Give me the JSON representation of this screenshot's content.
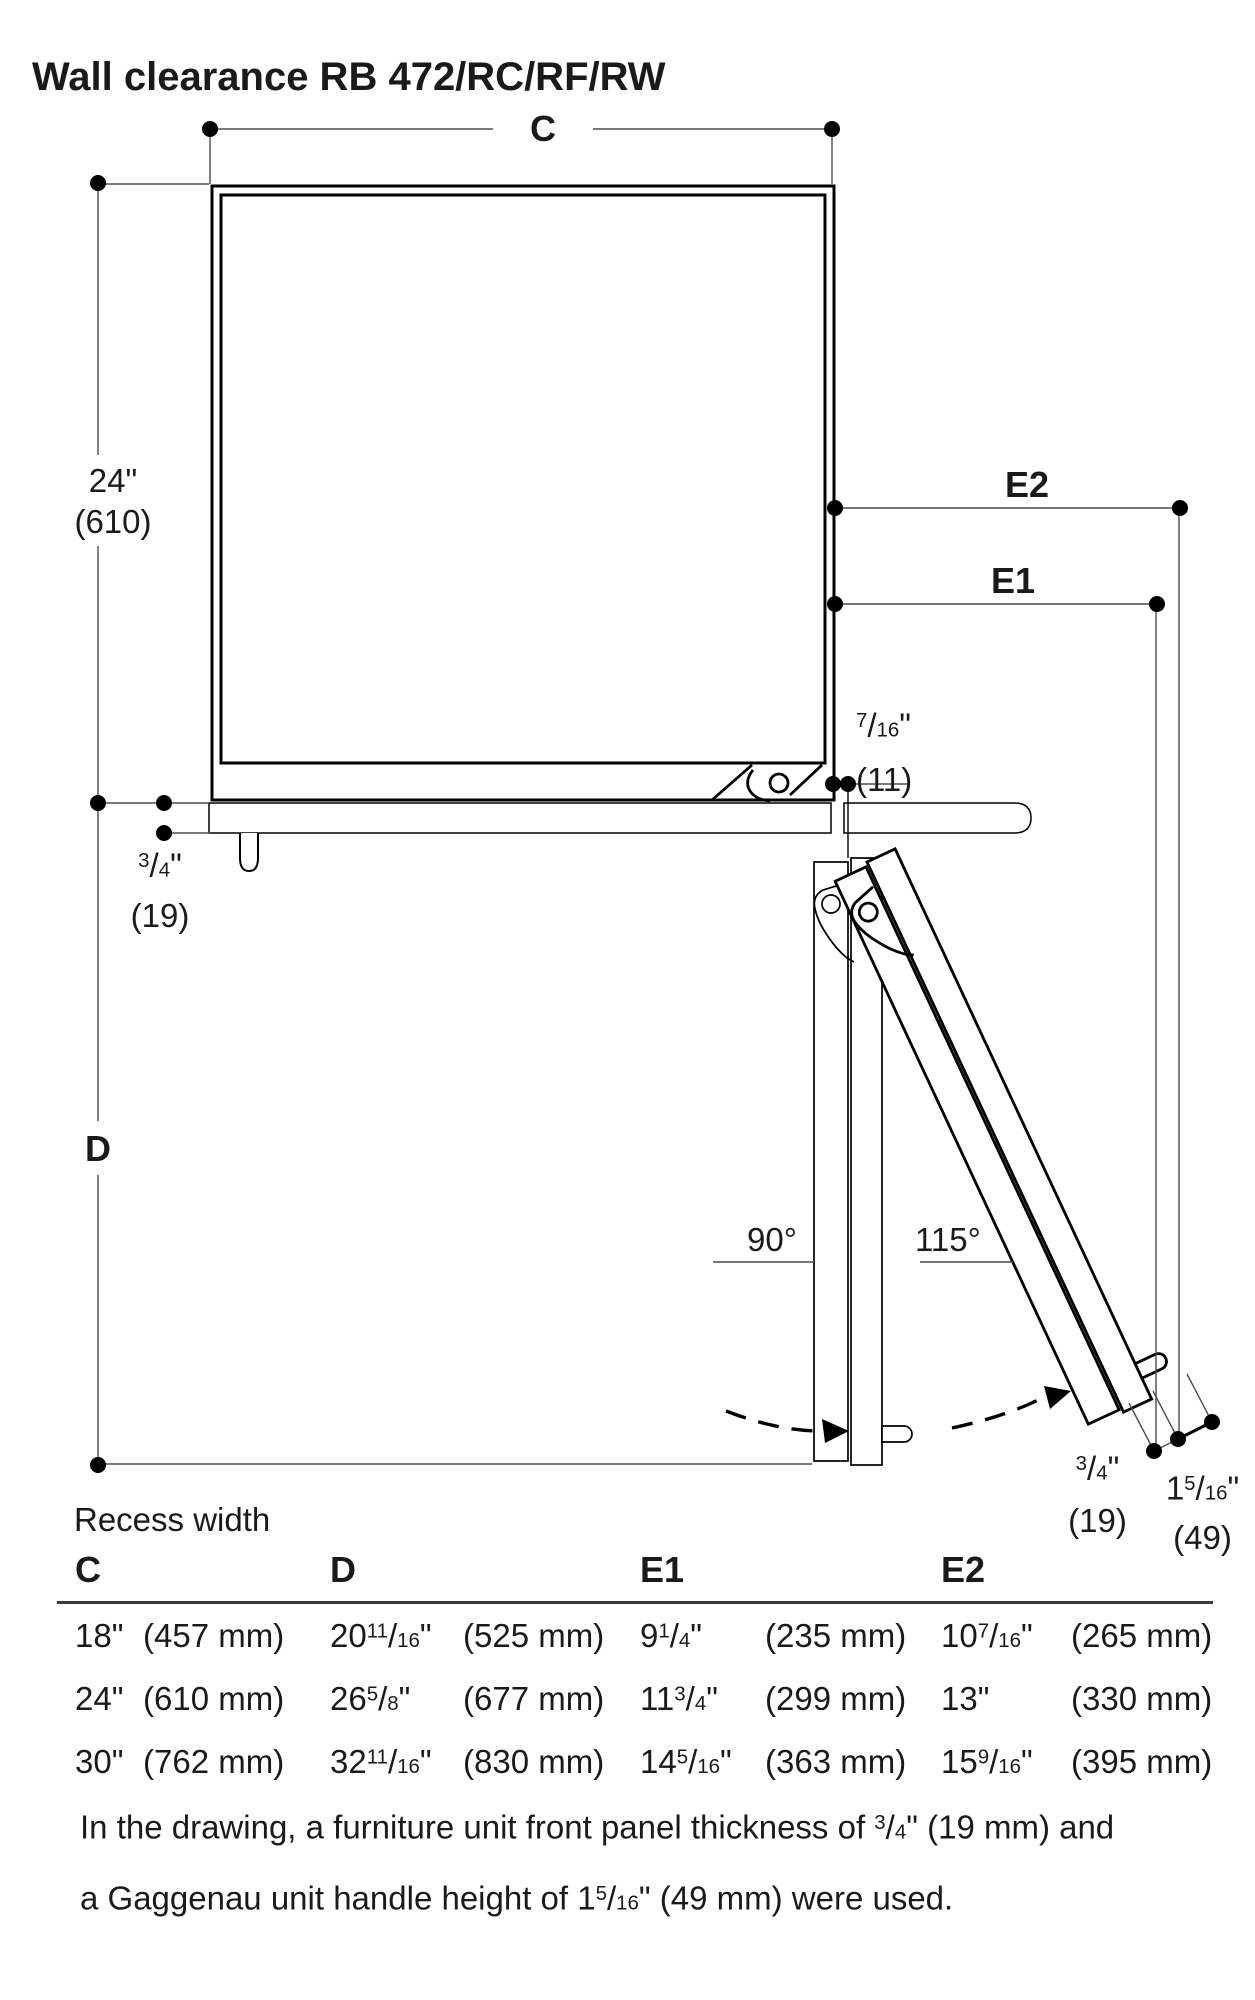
{
  "title": "Wall clearance RB 472/RC/RF/RW",
  "drawing": {
    "dim_c": "C",
    "dim_d": "D",
    "dim_e1": "E1",
    "dim_e2": "E2",
    "depth": {
      "inches": "24\"",
      "mm": "(610)"
    },
    "panel_left": {
      "num": "3",
      "slash": "/",
      "den": "4",
      "unit": "\"",
      "mm": "(19)"
    },
    "gap": {
      "num": "7",
      "slash": "/",
      "den": "16",
      "unit": "\"",
      "mm": "(11)"
    },
    "angle_door_90": "90°",
    "angle_door_115": "115°",
    "panel_tip": {
      "num": "3",
      "slash": "/",
      "den": "4",
      "unit": "\"",
      "mm": "(19)"
    },
    "handle_tip": {
      "whole": "1",
      "num": "5",
      "slash": "/",
      "den": "16",
      "unit": "\"",
      "mm": "(49)"
    }
  },
  "table": {
    "caption": "Recess width",
    "headers": {
      "c": "C",
      "d": "D",
      "e1": "E1",
      "e2": "E2"
    },
    "rows": [
      {
        "c_in": "18\"",
        "c_mm": "(457 mm)",
        "d_whole": "20",
        "d_num": "11",
        "d_slash": "/",
        "d_den": "16",
        "d_unit": "\"",
        "d_mm": "(525 mm)",
        "e1_whole": "9",
        "e1_num": "1",
        "e1_slash": "/",
        "e1_den": "4",
        "e1_unit": "\"",
        "e1_mm": "(235 mm)",
        "e2_whole": "10",
        "e2_num": "7",
        "e2_slash": "/",
        "e2_den": "16",
        "e2_unit": "\"",
        "e2_mm": "(265 mm)"
      },
      {
        "c_in": "24\"",
        "c_mm": "(610 mm)",
        "d_whole": "26",
        "d_num": "5",
        "d_slash": "/",
        "d_den": "8",
        "d_unit": "\"",
        "d_mm": "(677 mm)",
        "e1_whole": "11",
        "e1_num": "3",
        "e1_slash": "/",
        "e1_den": "4",
        "e1_unit": "\"",
        "e1_mm": "(299 mm)",
        "e2_whole": "13",
        "e2_num": "",
        "e2_slash": "",
        "e2_den": "",
        "e2_unit": "\"",
        "e2_mm": "(330 mm)"
      },
      {
        "c_in": "30\"",
        "c_mm": "(762 mm)",
        "d_whole": "32",
        "d_num": "11",
        "d_slash": "/",
        "d_den": "16",
        "d_unit": "\"",
        "d_mm": "(830 mm)",
        "e1_whole": "14",
        "e1_num": "5",
        "e1_slash": "/",
        "e1_den": "16",
        "e1_unit": "\"",
        "e1_mm": "(363 mm)",
        "e2_whole": "15",
        "e2_num": "9",
        "e2_slash": "/",
        "e2_den": "16",
        "e2_unit": "\"",
        "e2_mm": "(395 mm)"
      }
    ]
  },
  "footnote": {
    "line1_pre": "In the drawing, a furniture unit front panel thickness of ",
    "line1_frac": {
      "num": "3",
      "slash": "/",
      "den": "4",
      "unit": "\""
    },
    "line1_post": " (19 mm) and",
    "line2_pre": "a Gaggenau unit handle height of ",
    "line2_frac": {
      "whole": "1",
      "num": "5",
      "slash": "/",
      "den": "16",
      "unit": "\""
    },
    "line2_post": " (49 mm) were used."
  }
}
